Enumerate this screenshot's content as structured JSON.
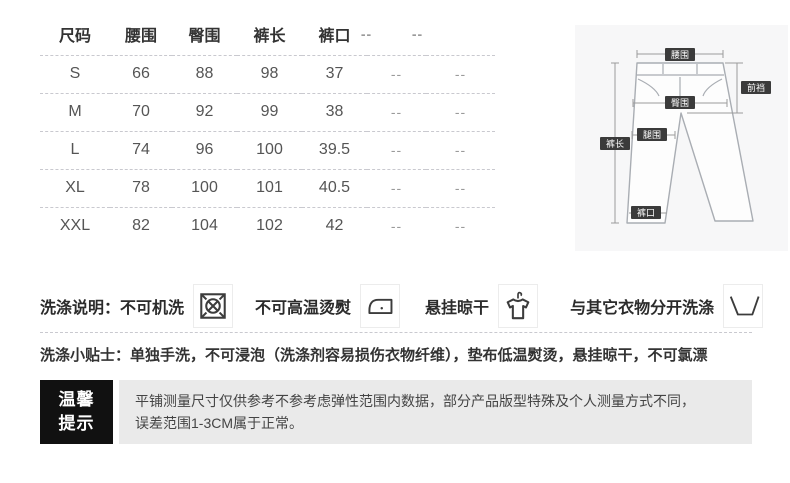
{
  "table": {
    "headers": [
      "尺码",
      "腰围",
      "臀围",
      "裤长",
      "裤口",
      "--",
      "--"
    ],
    "rows": [
      [
        "S",
        "66",
        "88",
        "98",
        "37",
        "--",
        "--"
      ],
      [
        "M",
        "70",
        "92",
        "99",
        "38",
        "--",
        "--"
      ],
      [
        "L",
        "74",
        "96",
        "100",
        "39.5",
        "--",
        "--"
      ],
      [
        "XL",
        "78",
        "100",
        "101",
        "40.5",
        "--",
        "--"
      ],
      [
        "XXL",
        "82",
        "104",
        "102",
        "42",
        "--",
        "--"
      ]
    ]
  },
  "diagram": {
    "labels": {
      "waist": "腰围",
      "front_rise": "前裆",
      "hip": "臀围",
      "thigh": "腿围",
      "length": "裤长",
      "leg_opening": "裤口"
    }
  },
  "care": {
    "title": "洗涤说明：",
    "items": [
      {
        "label": "不可机洗",
        "icon": "do-not-machine-wash-icon"
      },
      {
        "label": "不可高温烫熨",
        "icon": "do-not-iron-icon"
      },
      {
        "label": "悬挂晾干",
        "icon": "hang-dry-icon"
      },
      {
        "label": "与其它衣物分开洗涤",
        "icon": "wash-separately-icon"
      }
    ],
    "tips_title": "洗涤小贴士：",
    "tips_text": "单独手洗，不可浸泡（洗涤剂容易损伤衣物纤维），垫布低温熨烫，悬挂晾干，不可氯漂"
  },
  "notice": {
    "badge_line1": "温馨",
    "badge_line2": "提示",
    "text_line1": "平铺测量尺寸仅供参考不参考虑弹性范围内数据，部分产品版型特殊及个人测量方式不同，",
    "text_line2": "误差范围1-3CM属于正常。"
  },
  "colors": {
    "badge_bg": "#111111",
    "notice_bg": "#eaeaea",
    "diagram_bg": "#f7f7f8",
    "text_dark": "#333333",
    "dash_line": "#c9c9cf"
  }
}
